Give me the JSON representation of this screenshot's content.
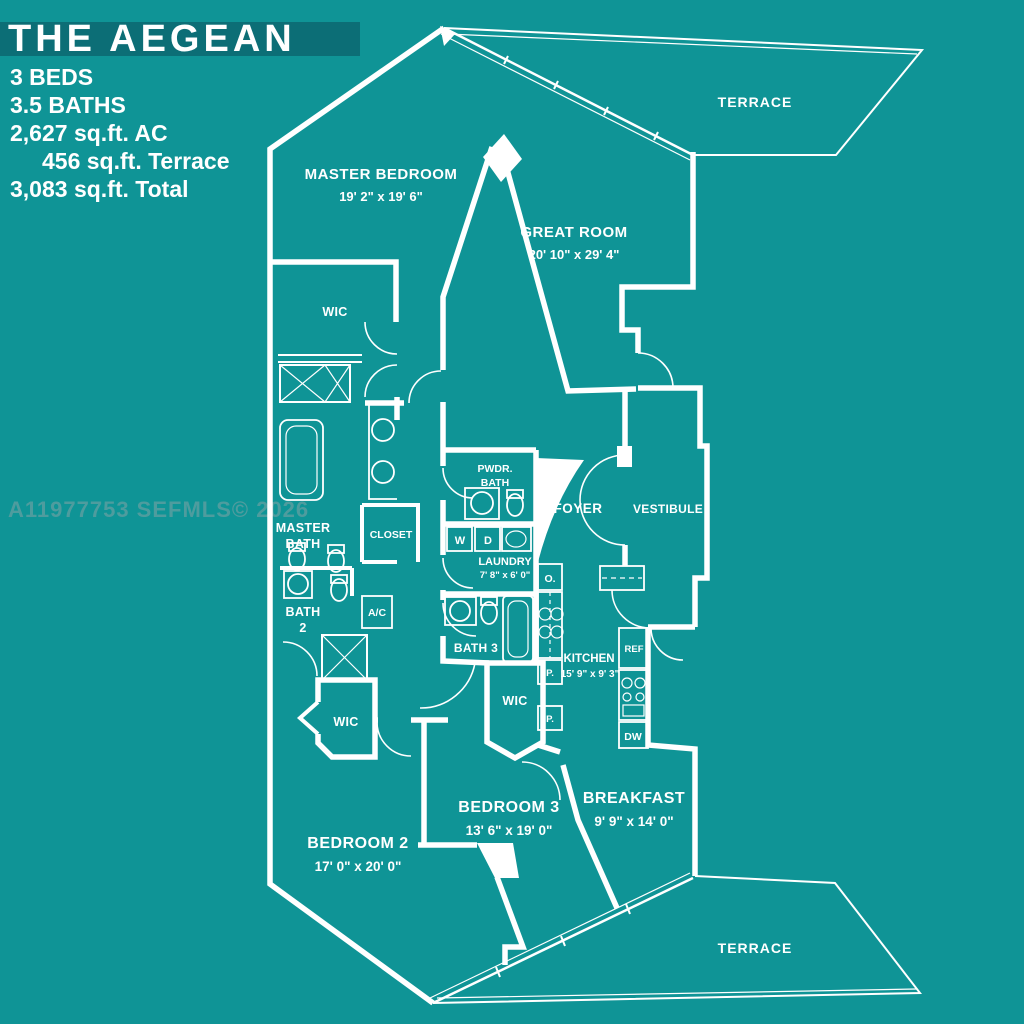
{
  "colors": {
    "background": "#0F9496",
    "banner": "#0C6E76",
    "line": "#FFFFFF",
    "watermark": "#4E9C9E"
  },
  "title_block": {
    "title": "THE AEGEAN",
    "beds": "3 BEDS",
    "baths": "3.5 BATHS",
    "area_ac": "2,627 sq.ft. AC",
    "area_terrace": "456 sq.ft. Terrace",
    "area_total": "3,083 sq.ft. Total"
  },
  "watermark": "A11977753 SEFMLS© 2026",
  "rooms": {
    "terrace_top": {
      "name": "TERRACE"
    },
    "master_bedroom": {
      "name": "MASTER BEDROOM",
      "dims": "19' 2\" x 19' 6\""
    },
    "great_room": {
      "name": "GREAT ROOM",
      "dims": "20' 10\" x 29' 4\""
    },
    "wic_master": {
      "name": "WIC"
    },
    "master_bath": {
      "line1": "MASTER",
      "line2": "BATH"
    },
    "closet": {
      "name": "CLOSET"
    },
    "pwdr_bath": {
      "line1": "PWDR.",
      "line2": "BATH"
    },
    "foyer": {
      "name": "FOYER"
    },
    "vestibule": {
      "name": "VESTIBULE"
    },
    "laundry": {
      "name": "LAUNDRY",
      "dims": "7' 8\" x 6' 0\""
    },
    "bath_2": {
      "line1": "BATH",
      "line2": "2"
    },
    "bath_3": {
      "name": "BATH 3"
    },
    "kitchen": {
      "name": "KITCHEN",
      "dims": "15' 9\" x 9' 3\""
    },
    "wic_bedroom3": {
      "name": "WIC"
    },
    "wic_bedroom2": {
      "name": "WIC"
    },
    "bedroom_3": {
      "name": "BEDROOM 3",
      "dims": "13' 6\" x 19' 0\""
    },
    "breakfast": {
      "name": "BREAKFAST",
      "dims": "9' 9\" x 14' 0\""
    },
    "bedroom_2": {
      "name": "BEDROOM 2",
      "dims": "17' 0\" x 20' 0\""
    },
    "terrace_bottom": {
      "name": "TERRACE"
    }
  },
  "fixtures": {
    "washer": "W",
    "dryer": "D",
    "oven": "O.",
    "pantry_upper": "P.",
    "pantry_lower": "P.",
    "refrigerator": "REF",
    "dishwasher": "DW",
    "ac_closet": "A/C"
  }
}
